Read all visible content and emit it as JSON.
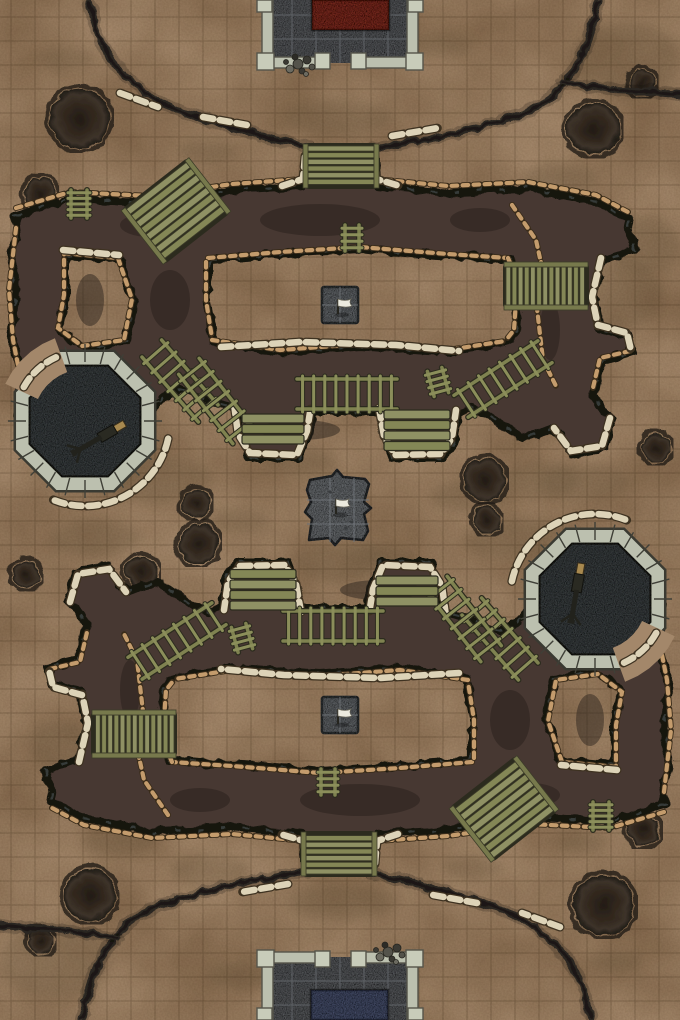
{
  "meta": {
    "label": "Top-down trench warfare battle map with grid"
  },
  "palette": {
    "ground": "#a3876a",
    "grid_line": "rgba(48,30,12,0.25)",
    "stain": "#6b563c",
    "trench_fill": "#463731",
    "trench_edge": "#15130e",
    "trench_blotch": "#241d18",
    "rock_highlight": "#66727c",
    "ridge": "#2b2720",
    "bag_cream": "#ddd3b8",
    "bag_cream_dark": "#3e3221",
    "bag_tan": "#c49c6d",
    "bag_tan_dark": "#3a2c1a",
    "wood": "#8f9164",
    "wood_alt": "#848756",
    "wood_dark": "#2c2b1e",
    "stone_wall": "#bcc0af",
    "stone_wall_edge": "#3a3a32",
    "stone_floor": "#6e7175",
    "stone_floor_line": "#5a5d61",
    "octagon_pit": "#4d5254",
    "platform": "#84888c",
    "rug_red": "#9c3a2d",
    "rug_blue": "#5a6485",
    "flag_white": "#eceadf",
    "gun_dark": "#22221c",
    "gun_wood": "#a8894f",
    "crater_ring": "#201c15"
  },
  "canvas": {
    "w": 680,
    "h": 1020
  },
  "grid": {
    "cell": 24,
    "ox": 11,
    "oy": 17
  },
  "stains": [
    [
      150,
      478,
      62,
      24
    ],
    [
      345,
      562,
      52,
      20
    ],
    [
      470,
      497,
      40,
      16
    ],
    [
      620,
      295,
      42,
      36
    ],
    [
      645,
      245,
      36,
      28
    ],
    [
      208,
      152,
      30,
      12
    ],
    [
      100,
      206,
      26,
      11
    ],
    [
      338,
      118,
      55,
      18
    ],
    [
      560,
      178,
      38,
      14
    ],
    [
      48,
      300,
      16,
      30
    ],
    [
      300,
      462,
      36,
      13
    ],
    [
      585,
      482,
      46,
      18
    ],
    [
      440,
      44,
      34,
      12
    ],
    [
      65,
      58,
      28,
      11
    ],
    [
      240,
      520,
      30,
      12
    ],
    [
      520,
      540,
      55,
      20
    ],
    [
      210,
      870,
      40,
      16
    ],
    [
      120,
      760,
      40,
      30
    ],
    [
      60,
      745,
      30,
      24
    ],
    [
      472,
      868,
      30,
      12
    ],
    [
      580,
      842,
      26,
      11
    ],
    [
      342,
      902,
      55,
      18
    ],
    [
      120,
      842,
      38,
      14
    ],
    [
      632,
      720,
      16,
      30
    ],
    [
      380,
      558,
      36,
      13
    ],
    [
      95,
      538,
      46,
      18
    ],
    [
      240,
      976,
      34,
      12
    ],
    [
      615,
      962,
      28,
      11
    ],
    [
      340,
      640,
      40,
      14
    ],
    [
      540,
      480,
      40,
      18
    ],
    [
      625,
      60,
      55,
      38
    ],
    [
      55,
      960,
      55,
      38
    ]
  ],
  "craters": [
    [
      78,
      117,
      30
    ],
    [
      38,
      192,
      16
    ],
    [
      592,
      127,
      26
    ],
    [
      641,
      81,
      13
    ],
    [
      655,
      447,
      14
    ],
    [
      483,
      478,
      21
    ],
    [
      195,
      502,
      14
    ],
    [
      140,
      570,
      16
    ],
    [
      602,
      903,
      30
    ],
    [
      642,
      828,
      16
    ],
    [
      88,
      893,
      26
    ],
    [
      39,
      939,
      13
    ],
    [
      25,
      573,
      14
    ],
    [
      197,
      542,
      20
    ],
    [
      485,
      518,
      14
    ]
  ],
  "half": {
    "ridges": [
      "M88,0 C95,42 112,72 152,96 C192,119 242,128 306,146",
      "M597,0 C586,46 572,82 541,101 C506,123 440,136 374,146",
      "M560,80 C600,90 646,87 680,93"
    ],
    "ridge_bags": [
      "M120,93 L158,107",
      "M203,117 L247,125",
      "M392,136 L438,128"
    ],
    "trench_path": "M14,213 L70,197 L150,201 L232,189 L303,184 L306,149 L372,149 L375,184 L448,191 L528,187 L596,200 L628,217 L633,248 L601,258 L592,297 L598,327 L626,334 L630,351 L600,358 L591,393 L610,418 L602,447 L571,452 L553,427 L520,436 L488,414 L470,406 L456,412 L452,442 L442,456 L392,456 L383,433 L379,410 L311,410 L307,434 L298,456 L248,456 L238,432 L234,406 L205,398 L178,388 L160,396 L150,412 L140,430 L112,442 L82,440 L55,449 L28,439 L16,418 L22,380 L10,340 L14,290 L8,250 L16,230 Z M208,258 L280,252 L360,247 L448,254 L508,258 L514,272 L516,300 L514,330 L506,340 L448,350 L360,344 L280,350 L212,340 L206,300 L206,262 Z M64,253 L118,258 L132,299 L124,340 L82,346 L58,328 L64,295 Z",
    "blotches": [
      [
        320,
        220,
        60,
        16
      ],
      [
        150,
        225,
        30,
        12
      ],
      [
        90,
        300,
        14,
        26
      ],
      [
        480,
        220,
        30,
        12
      ],
      [
        300,
        430,
        40,
        10
      ],
      [
        550,
        330,
        10,
        30
      ],
      [
        170,
        300,
        20,
        30
      ],
      [
        420,
        430,
        24,
        8
      ]
    ],
    "bags_cream": [
      "M282,186 L303,179 L305,156",
      "M374,156 L376,179 L400,186",
      "M221,347 L300,342 L396,345 L459,351",
      "M234,404 L238,434 L250,453 L297,455 L307,431 L311,406",
      "M379,408 L384,436 L395,455 L441,454 L452,438 L456,410",
      "M601,258 L592,297 L598,326",
      "M598,325 L627,333 L631,350",
      "M610,418 L602,446 L571,451 L554,428",
      "M63,250 L119,255"
    ],
    "bags_tan": [
      "M16,208 L70,192 L150,196 L232,184 L303,179",
      "M375,179 L448,186 L528,182 L596,195 L628,212",
      "M208,258 L280,252 L360,247 L448,254 L508,258",
      "M206,262 L206,300 L212,338",
      "M212,340 L280,350 L360,344 L448,350 L505,341",
      "M508,258 L514,272 L516,300 L514,330 L506,340",
      "M512,205 L536,240 L541,263",
      "M541,262 L536,300 L543,360 L557,388",
      "M630,351 L600,358 L592,392",
      "M16,228 L9,290 L13,340 L21,380 L16,416",
      "M28,437 L60,448 L90,440 L120,437 L142,423",
      "M64,253 L118,258 L132,299 L124,340 L82,346 L58,328 L64,295 Z"
    ],
    "ladders": [
      [
        79,
        204,
        28,
        16,
        90,
        5
      ],
      [
        180,
        381,
        86,
        26,
        49,
        7
      ],
      [
        216,
        401,
        88,
        26,
        52,
        7
      ],
      [
        347,
        394,
        100,
        30,
        0,
        9
      ],
      [
        438,
        382,
        26,
        15,
        75,
        4
      ],
      [
        503,
        379,
        100,
        26,
        -33,
        8
      ],
      [
        352,
        238,
        26,
        14,
        90,
        4
      ]
    ],
    "bridges": [
      [
        341,
        166,
        66,
        40,
        0,
        6,
        "h"
      ],
      [
        176,
        211,
        76,
        64,
        -38,
        8,
        "h"
      ],
      [
        546,
        286,
        80,
        38,
        0,
        13,
        "v"
      ]
    ],
    "benches": [
      [
        242,
        414,
        62,
        3
      ],
      [
        384,
        410,
        66,
        4
      ]
    ],
    "flag_squares": [
      [
        322,
        287,
        36
      ]
    ],
    "octagon": {
      "cx": 85,
      "cy": 421,
      "r_out": 76,
      "r_in": 60,
      "bag_arc": [
        12,
        112
      ],
      "entry_arc": [
        205,
        250
      ]
    }
  },
  "guns": [
    {
      "x": 103,
      "y": 436,
      "angle": 150
    },
    {
      "x": 577,
      "y": 588,
      "angle": 100
    }
  ],
  "platform": {
    "path": "M310,480 L332,476 L337,470 L343,477 L365,479 L369,484 L364,502 L371,508 L364,514 L368,531 L363,540 L341,538 L335,545 L329,538 L309,540 L312,519 L305,512 L311,502 L307,490 Z",
    "tiles_v": [
      330,
      354
    ],
    "tiles_h": [
      500,
      524
    ],
    "debris": [
      [
        346,
        528
      ],
      [
        352,
        522
      ],
      [
        330,
        492
      ]
    ]
  },
  "flags": [
    [
      338,
      314
    ],
    [
      336,
      514
    ],
    [
      338,
      724
    ]
  ],
  "buildings": [
    {
      "floor": [
        268,
        0,
        144,
        63
      ],
      "rug": [
        312,
        0,
        77,
        30
      ],
      "rug_color": "#9c3a2d",
      "walls": [
        [
          262,
          0,
          11,
          63
        ],
        [
          407,
          0,
          11,
          63
        ],
        [
          262,
          57,
          61,
          11
        ],
        [
          357,
          57,
          61,
          11
        ]
      ],
      "blocks": [
        [
          257,
          53,
          17,
          17
        ],
        [
          406,
          53,
          17,
          17
        ],
        [
          315,
          53,
          15,
          16
        ],
        [
          351,
          53,
          15,
          16
        ],
        [
          257,
          0,
          15,
          12
        ],
        [
          408,
          0,
          15,
          12
        ]
      ],
      "rubble": [
        298,
        64
      ],
      "tiles_v": [
        292,
        316,
        340,
        364,
        388
      ],
      "tiles_h": [
        15,
        39
      ]
    },
    {
      "floor": [
        268,
        957,
        144,
        63
      ],
      "rug": [
        311,
        990,
        77,
        30
      ],
      "rug_color": "#5a6485",
      "walls": [
        [
          262,
          957,
          11,
          63
        ],
        [
          407,
          957,
          11,
          63
        ],
        [
          262,
          952,
          61,
          11
        ],
        [
          357,
          952,
          61,
          11
        ]
      ],
      "blocks": [
        [
          257,
          950,
          17,
          17
        ],
        [
          406,
          950,
          17,
          17
        ],
        [
          315,
          951,
          15,
          16
        ],
        [
          351,
          951,
          15,
          16
        ],
        [
          257,
          1008,
          15,
          12
        ],
        [
          408,
          1008,
          15,
          12
        ]
      ],
      "rubble": [
        388,
        952
      ],
      "tiles_v": [
        292,
        316,
        340,
        364,
        388
      ],
      "tiles_h": [
        981,
        1005
      ]
    }
  ]
}
